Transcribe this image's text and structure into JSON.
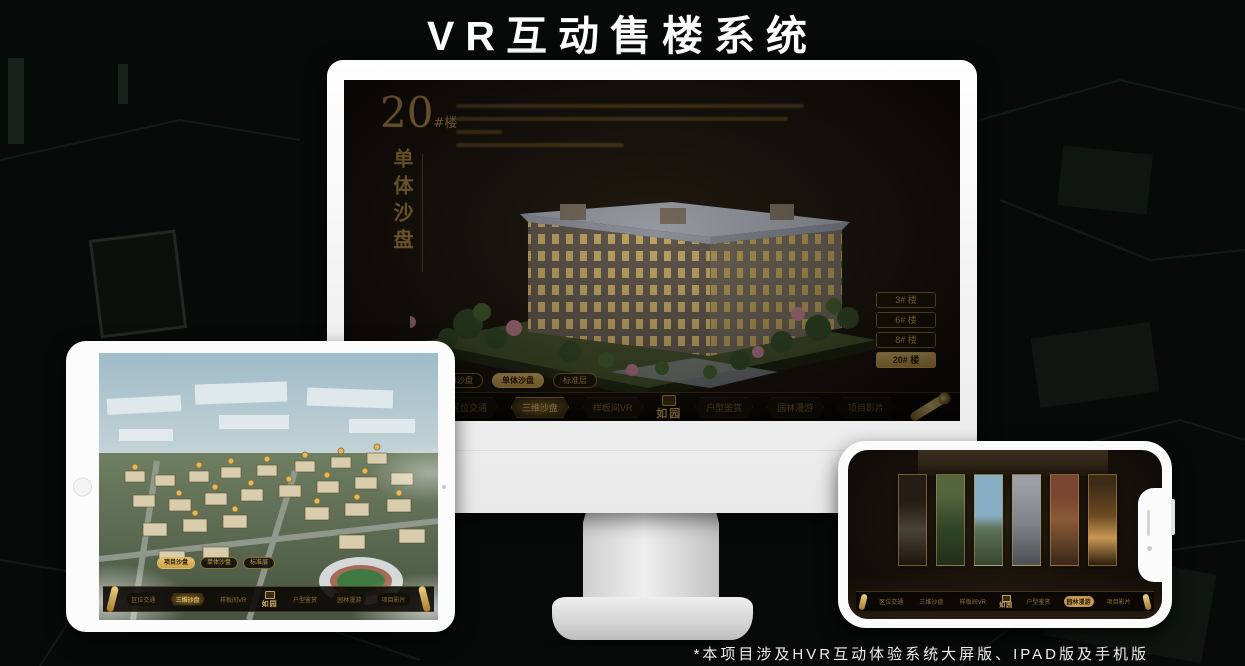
{
  "page": {
    "title": "VR互动售楼系统",
    "footnote": "*本项目涉及HVR互动体验系统大屏版、IPAD版及手机版"
  },
  "colors": {
    "gold": "#c9a050",
    "gold_bright": "#e7c472",
    "screen_bg": "#16110c",
    "page_bg": "#070a08"
  },
  "monitor": {
    "headline": {
      "number": "20",
      "suffix": "#楼",
      "vertical_title": "单体沙盘"
    },
    "building_buttons": [
      {
        "label": "3# 楼",
        "active": false
      },
      {
        "label": "6# 楼",
        "active": false
      },
      {
        "label": "8# 楼",
        "active": false
      },
      {
        "label": "20# 楼",
        "active": true
      }
    ],
    "sub_tabs": [
      {
        "label": "项目沙盘",
        "active": false
      },
      {
        "label": "单体沙盘",
        "active": true
      },
      {
        "label": "标准层",
        "active": false
      }
    ],
    "nav": {
      "items_left": [
        {
          "label": "区位交通",
          "active": false
        },
        {
          "label": "三维沙盘",
          "active": true
        },
        {
          "label": "样板间VR",
          "active": false
        }
      ],
      "logo": "如园",
      "items_right": [
        {
          "label": "户型鉴赏",
          "active": false
        },
        {
          "label": "园林漫游",
          "active": false
        },
        {
          "label": "项目影片",
          "active": false
        }
      ]
    }
  },
  "tablet": {
    "sub_tabs": [
      {
        "label": "项目沙盘",
        "active": true
      },
      {
        "label": "单体沙盘",
        "active": false
      },
      {
        "label": "标准层",
        "active": false
      }
    ],
    "nav": {
      "items_left": [
        {
          "label": "区位交通",
          "active": false
        },
        {
          "label": "三维沙盘",
          "active": true
        },
        {
          "label": "样板间VR",
          "active": false
        }
      ],
      "logo": "如园",
      "items_right": [
        {
          "label": "户型鉴赏",
          "active": false
        },
        {
          "label": "园林漫游",
          "active": false
        },
        {
          "label": "项目影片",
          "active": false
        }
      ]
    }
  },
  "phone": {
    "nav": {
      "items_left": [
        {
          "label": "区位交通",
          "active": false
        },
        {
          "label": "三维沙盘",
          "active": false
        },
        {
          "label": "样板间VR",
          "active": false
        }
      ],
      "logo": "如园",
      "items_right": [
        {
          "label": "户型鉴赏",
          "active": false
        },
        {
          "label": "园林漫游",
          "active": true
        },
        {
          "label": "项目影片",
          "active": false
        }
      ]
    }
  }
}
